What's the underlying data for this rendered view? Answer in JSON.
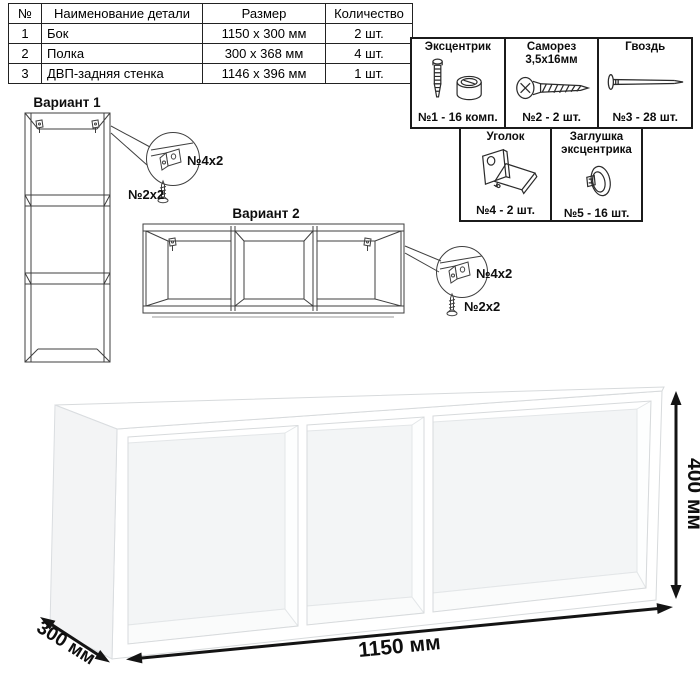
{
  "parts_table": {
    "headers": [
      "№",
      "Наименование детали",
      "Размер",
      "Количество"
    ],
    "rows": [
      [
        "1",
        "Бок",
        "1150 x 300 мм",
        "2 шт."
      ],
      [
        "2",
        "Полка",
        "300 x 368 мм",
        "4 шт."
      ],
      [
        "3",
        "ДВП-задняя стенка",
        "1146 x 396 мм",
        "1 шт."
      ]
    ]
  },
  "hardware": {
    "items": [
      {
        "name": "cam-lock",
        "title_lines": [
          "Эксцентрик"
        ],
        "qty": "№1 - 16 комп."
      },
      {
        "name": "screw",
        "title_lines": [
          "Саморез",
          "3,5х16мм"
        ],
        "qty": "№2 - 2 шт."
      },
      {
        "name": "nail",
        "title_lines": [
          "Гвоздь"
        ],
        "qty": "№3 - 28 шт."
      },
      {
        "name": "corner-bracket",
        "title_lines": [
          "Уголок"
        ],
        "qty": "№4 - 2 шт."
      },
      {
        "name": "cam-cover",
        "title_lines": [
          "Заглушка",
          "эксцентрика"
        ],
        "qty": "№5 - 16 шт."
      }
    ]
  },
  "variants": {
    "variant1": {
      "label": "Вариант 1",
      "callout_bracket": "№4х2",
      "callout_screw": "№2х2"
    },
    "variant2": {
      "label": "Вариант 2",
      "callout_bracket": "№4х2",
      "callout_screw": "№2х2"
    }
  },
  "dimensions": {
    "width": "1150 мм",
    "height": "400 мм",
    "depth": "300 мм"
  },
  "colors": {
    "line_art": "#3f3f3f",
    "dimension": "#141414",
    "panel_border": "#1b1b1b",
    "table_border": "#222222",
    "shelf_edge": "#d7dadc",
    "shelf_left_face": "#f3f4f5",
    "shelf_back_wall": "#f3f5f6",
    "shelf_bottom": "#fafbfb"
  }
}
